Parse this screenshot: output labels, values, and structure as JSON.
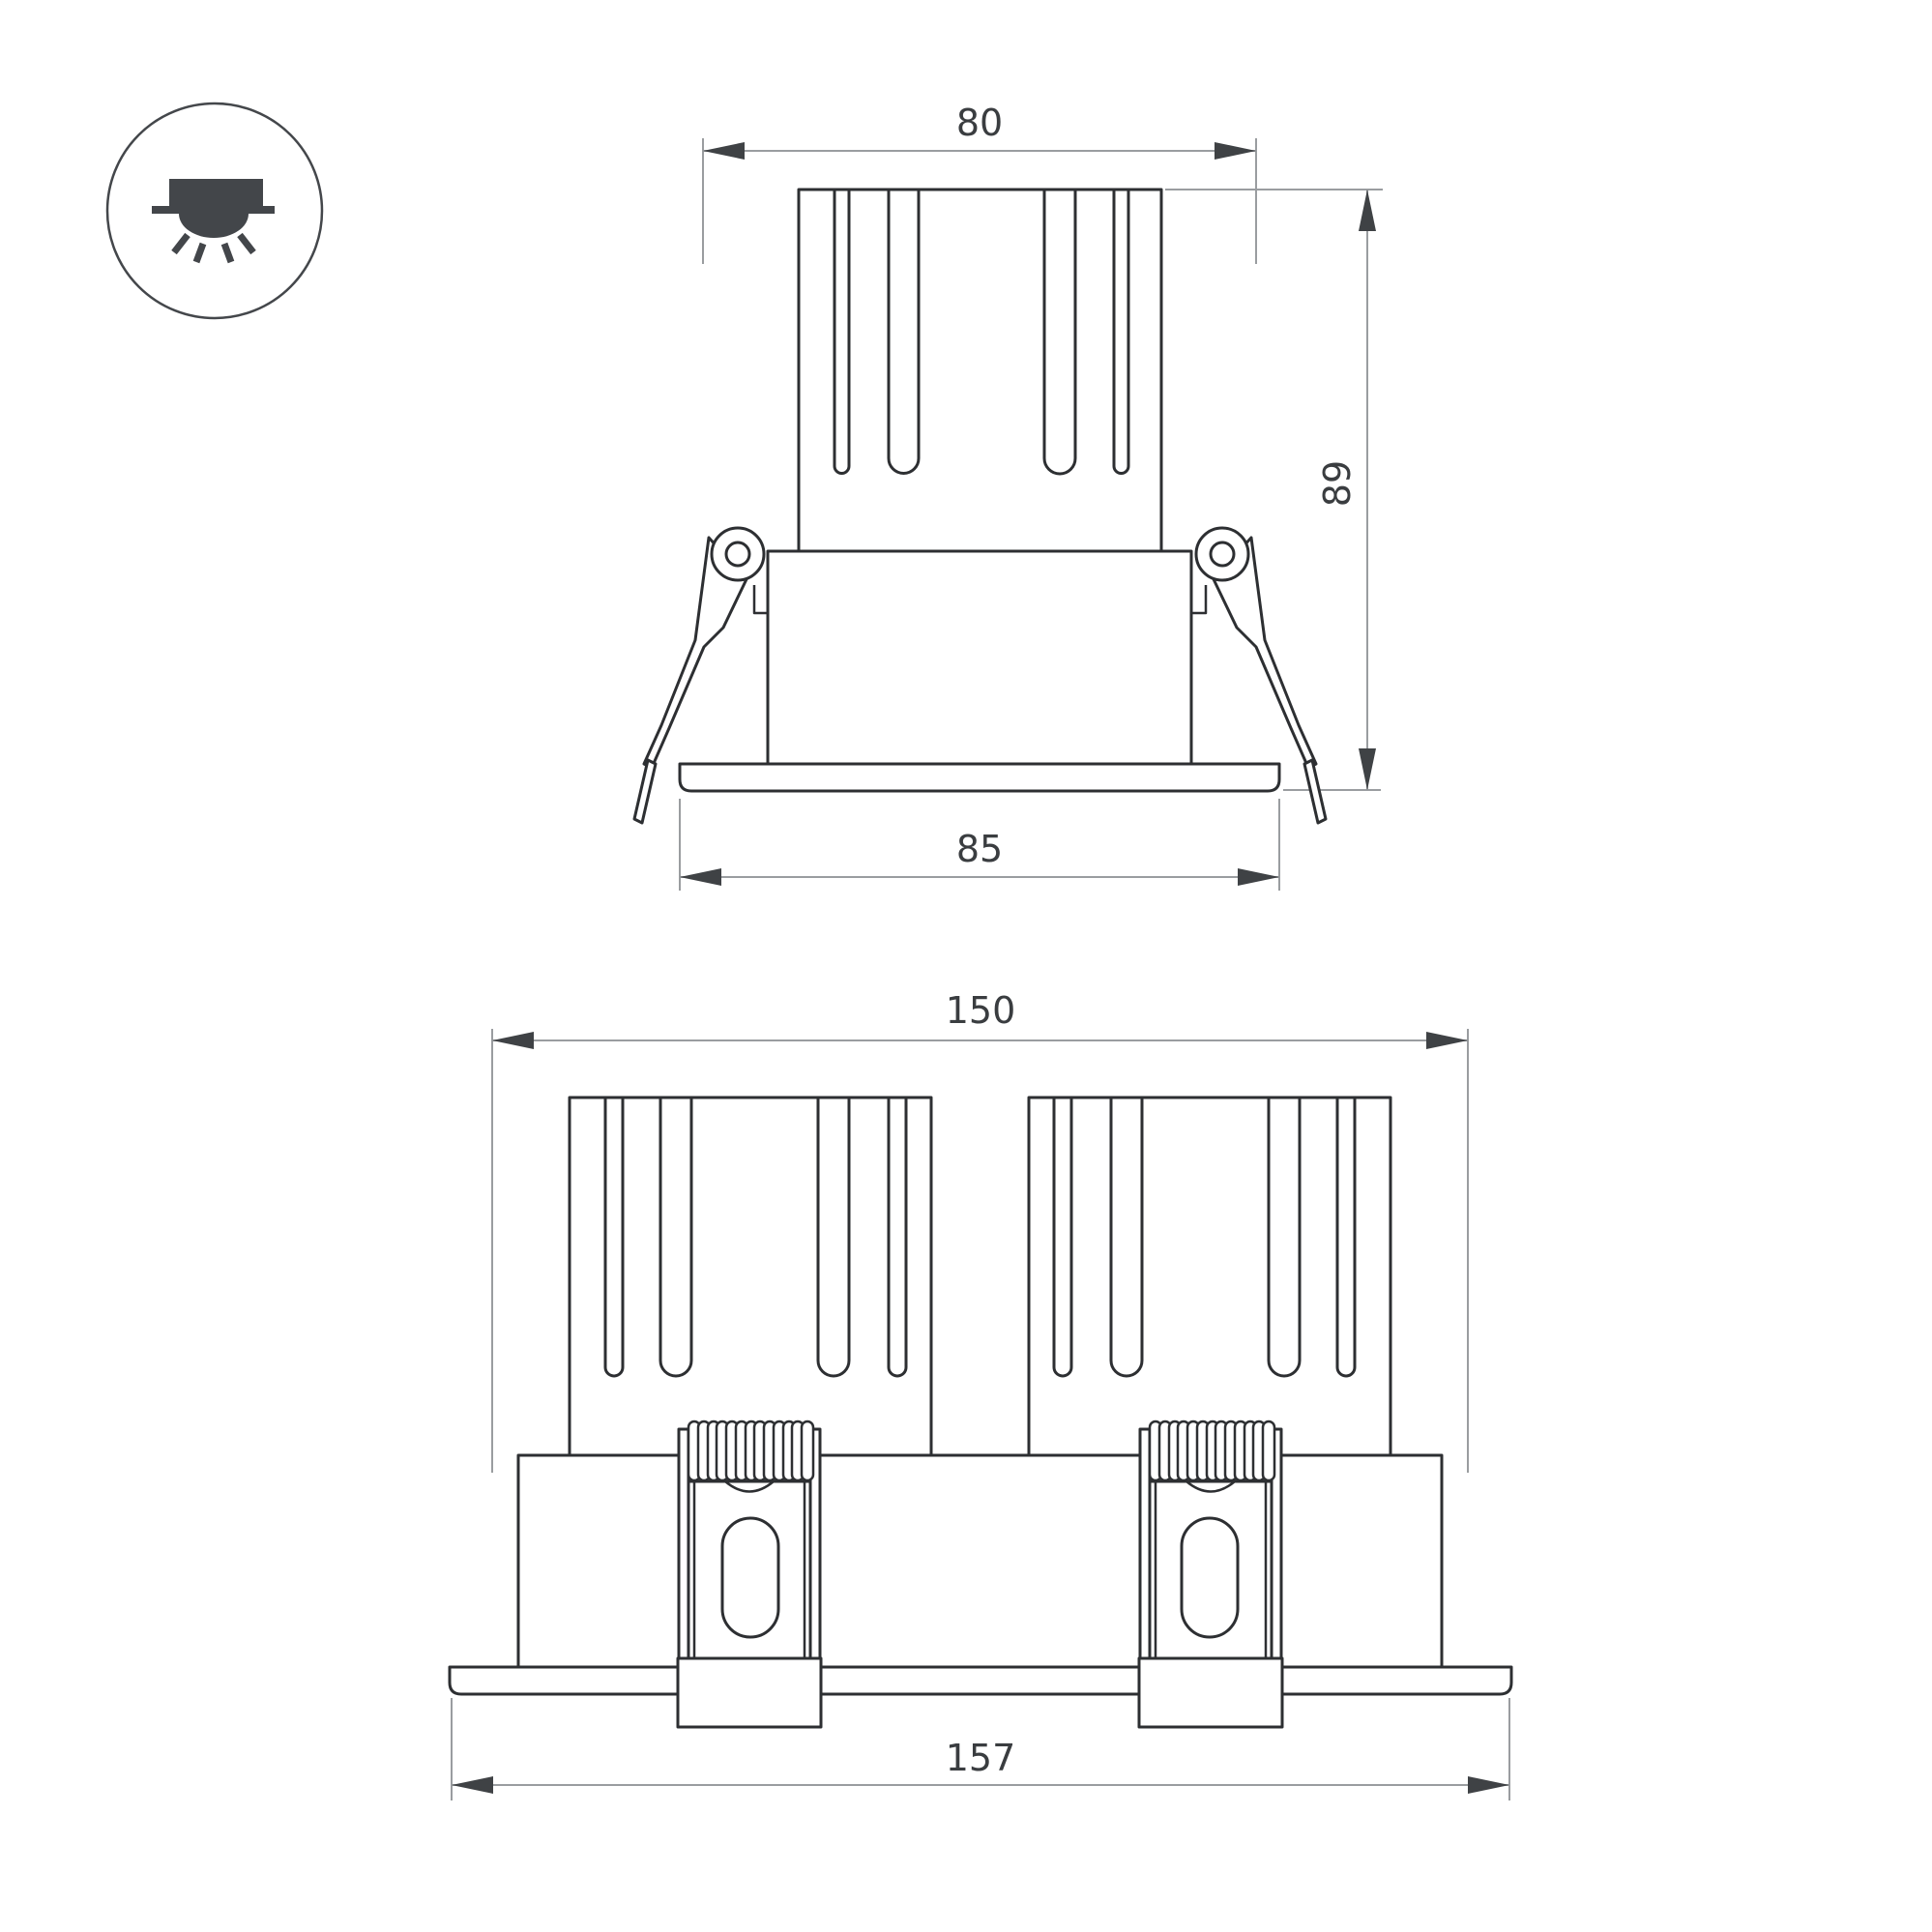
{
  "colors": {
    "background": "#ffffff",
    "outline": "#2d2f32",
    "dimension_line": "#9a9da0",
    "arrow_and_text": "#3f4245",
    "icon": "#43464a"
  },
  "icon": {
    "type": "recessed-downlight-icon"
  },
  "views": {
    "front": {
      "dimensions": {
        "width_top": "80",
        "height": "89",
        "width_flange": "85"
      }
    },
    "double": {
      "dimensions": {
        "width_top": "150",
        "width_flange": "157"
      }
    }
  }
}
